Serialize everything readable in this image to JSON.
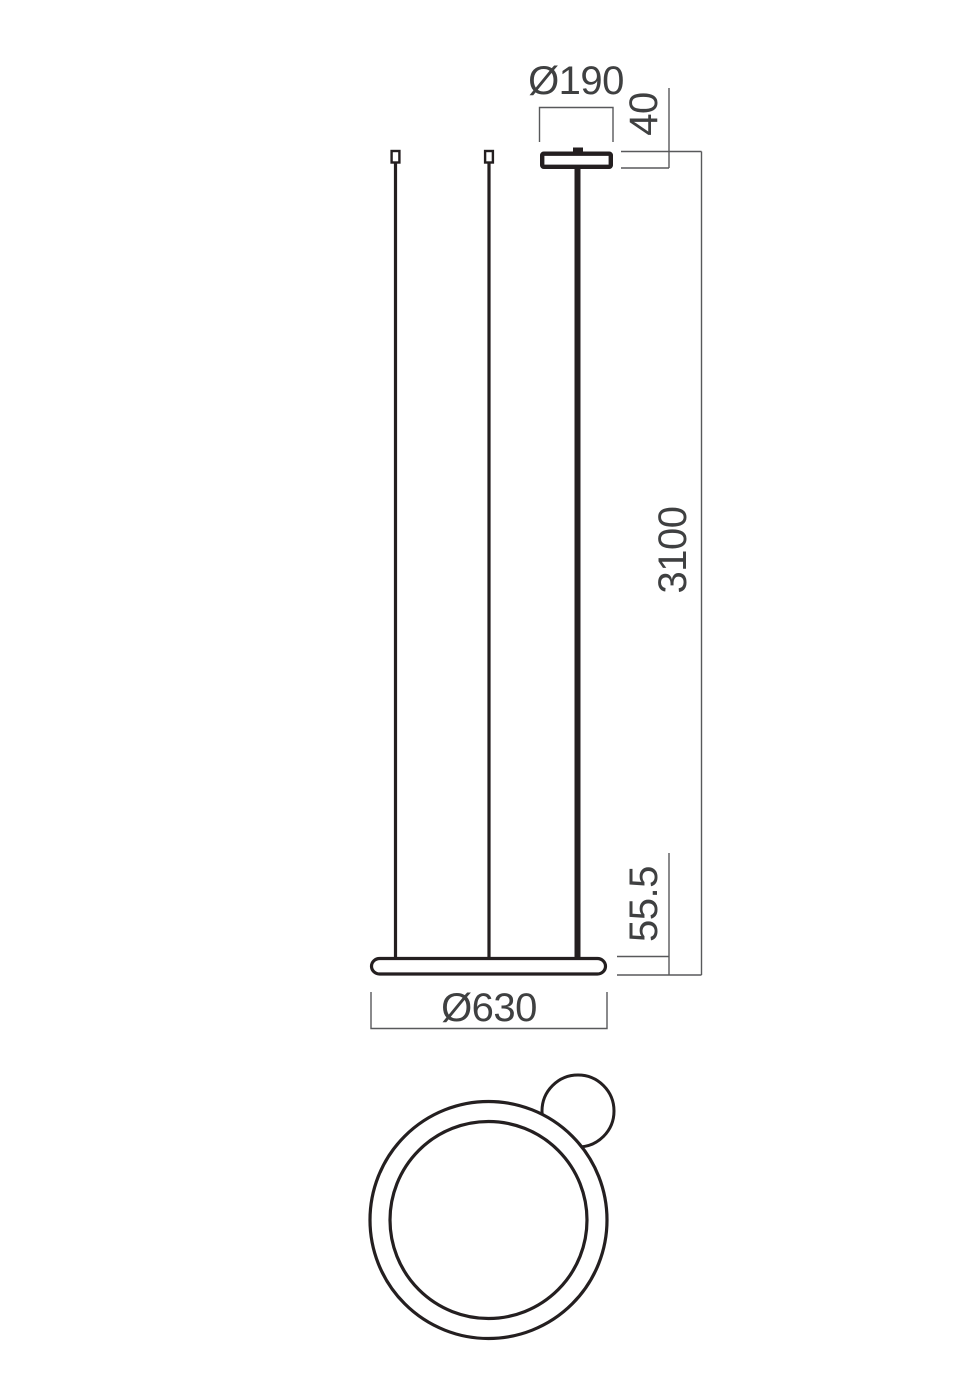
{
  "dimensions": {
    "canopy_diameter": "Ø190",
    "canopy_height": "40",
    "suspension_length": "3100",
    "ring_profile_height": "55.5",
    "ring_diameter": "Ø630"
  },
  "colors": {
    "object_line": "#241f20",
    "dimension_line": "#58595b",
    "label_text": "#3f4041",
    "background": "#ffffff"
  }
}
